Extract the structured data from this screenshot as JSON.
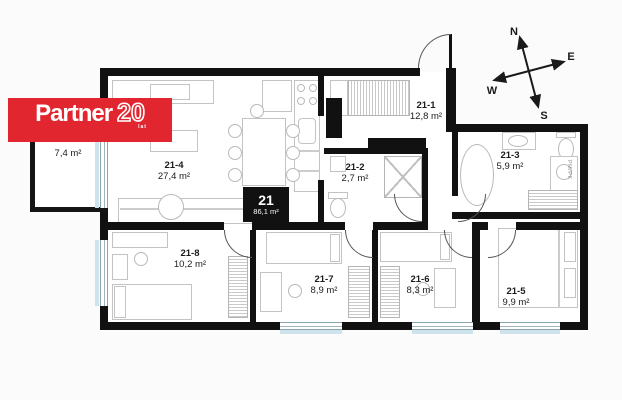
{
  "logo": {
    "brand": "Partner",
    "number": "20",
    "suffix": "lat"
  },
  "unit_badge": {
    "number": "21",
    "area": "86,1 m²"
  },
  "rooms": [
    {
      "id": "balcony",
      "number": "",
      "area": "7,4 m²"
    },
    {
      "id": "21-1",
      "number": "21-1",
      "area": "12,8 m²"
    },
    {
      "id": "21-2",
      "number": "21-2",
      "area": "2,7 m²"
    },
    {
      "id": "21-3",
      "number": "21-3",
      "area": "5,9 m²"
    },
    {
      "id": "21-4",
      "number": "21-4",
      "area": "27,4 m²"
    },
    {
      "id": "21-5",
      "number": "21-5",
      "area": "9,9 m²"
    },
    {
      "id": "21-6",
      "number": "21-6",
      "area": "8,3 m²"
    },
    {
      "id": "21-7",
      "number": "21-7",
      "area": "8,9 m²"
    },
    {
      "id": "21-8",
      "number": "21-8",
      "area": "10,2 m²"
    }
  ],
  "compass": {
    "n": "N",
    "e": "E",
    "s": "S",
    "w": "W"
  },
  "fixtures": {
    "washer_label": "PM/PK"
  },
  "colors": {
    "wall": "#111111",
    "logo_red": "#e2262f",
    "window_glass": "#cfe3ea",
    "furniture_line": "#c3c3c3"
  }
}
